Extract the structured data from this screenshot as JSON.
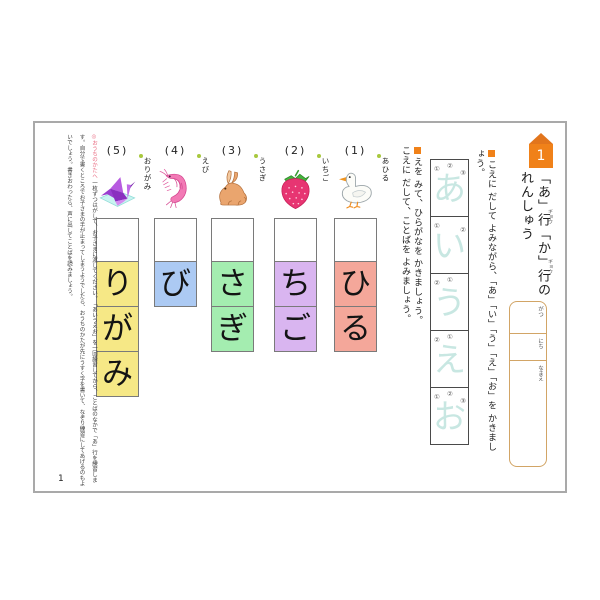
{
  "header": {
    "lesson_number": "1",
    "title_line1": "「あ」行「か」行の",
    "title_line2": "れんしゅう",
    "title_furigana": "ギョウ"
  },
  "instructions": {
    "trace": "こえに だして よみながら、「あ」「い」「う」「え」「お」を かきましょう。",
    "write": "えを みて、ひらがなを かきましょう。",
    "read": "こえに だして、ことばを よみましょう。"
  },
  "trace_column": {
    "characters": [
      {
        "char": "あ",
        "marks": [
          "①",
          "②",
          "③"
        ]
      },
      {
        "char": "い",
        "marks": [
          "①",
          "②"
        ]
      },
      {
        "char": "う",
        "marks": [
          "①",
          "②"
        ]
      },
      {
        "char": "え",
        "marks": [
          "①",
          "②"
        ]
      },
      {
        "char": "お",
        "marks": [
          "①",
          "②",
          "③"
        ]
      }
    ]
  },
  "date_name_box": {
    "month_label": "がつ",
    "day_label": "にち",
    "name_label": "なまえ"
  },
  "word_columns": [
    {
      "number": "(1)",
      "word": "あひる",
      "image": "duck-illustration",
      "empty_box": "",
      "letters": [
        "ひ",
        "る"
      ],
      "color": "#f4a79a"
    },
    {
      "number": "(2)",
      "word": "いちご",
      "image": "strawberry-illustration",
      "empty_box": "",
      "letters": [
        "ち",
        "ご"
      ],
      "color": "#d9b5f0"
    },
    {
      "number": "(3)",
      "word": "うさぎ",
      "image": "rabbit-illustration",
      "empty_box": "",
      "letters": [
        "さ",
        "ぎ"
      ],
      "color": "#a4edb0"
    },
    {
      "number": "(4)",
      "word": "えび",
      "image": "shrimp-illustration",
      "empty_box": "",
      "letters": [
        "び"
      ],
      "color": "#accaf3"
    },
    {
      "number": "(5)",
      "word": "おりがみ",
      "image": "origami-crane-illustration",
      "empty_box": "",
      "letters": [
        "り",
        "が",
        "み"
      ],
      "color": "#f6e886"
    }
  ],
  "parent_note": {
    "heading": "◎おうちのかたへ",
    "body": "一枚ずつはがして、お子さまに渡してください。「あいうえお」を一回練習してから、ことばのなかで「あ」行を練習します。自分で書くところでお子さまの手が止まってしまうようでしたら、おうちのかたが先にうすく字を書いて、なぞり練習にしてあげるのもよいでしょう。書きおわったら、声に出してことばを読みましょう。"
  },
  "page_number": "1",
  "colors": {
    "accent_orange": "#f08119",
    "badge_roof_orange": "#e2751c",
    "trace_char_blue": "#c8e7e2",
    "date_box_border": "#d2a566",
    "label_dot_green": "#a8c83e",
    "parent_heading_pink": "#e96a80",
    "box_pink": "#f4a79a",
    "box_purple": "#d9b5f0",
    "box_green": "#a4edb0",
    "box_blue": "#accaf3",
    "box_yellow": "#f6e886"
  }
}
